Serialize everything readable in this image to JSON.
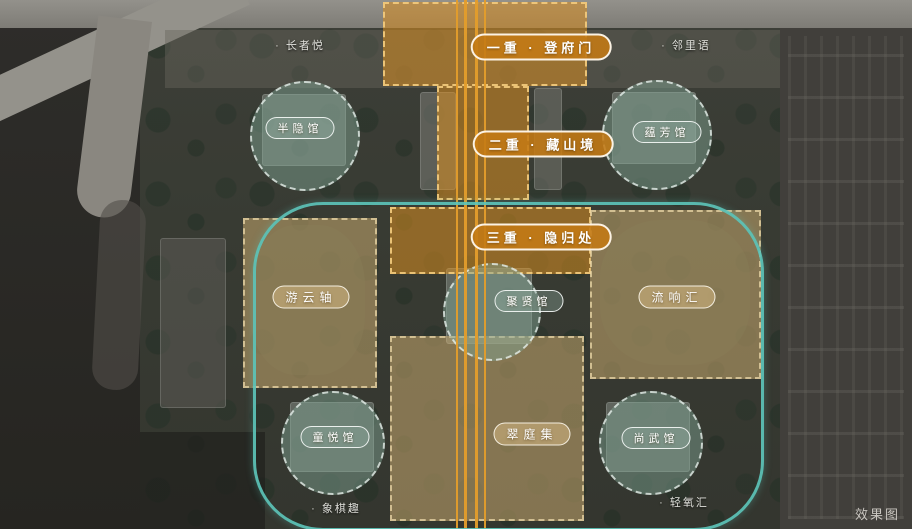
{
  "title": "小区景观规划效果图",
  "watermark": "效果图",
  "colors": {
    "axis_orange": "#e39d2b",
    "zone_orange_fill": "#d88e20",
    "zone_tan_fill": "#cfae72",
    "teal_loop": "#5cc3b8",
    "pavilion_circle_fill": "#80a293"
  },
  "axis_labels": [
    {
      "text": "一重 · 登府门"
    },
    {
      "text": "二重 · 藏山境"
    },
    {
      "text": "三重 · 隐归处"
    }
  ],
  "pavilion_labels": [
    {
      "text": "半隐馆"
    },
    {
      "text": "蕴芳馆"
    },
    {
      "text": "游云轴"
    },
    {
      "text": "聚贤馆"
    },
    {
      "text": "流响汇"
    },
    {
      "text": "童悦馆"
    },
    {
      "text": "翠庭集"
    },
    {
      "text": "尚武馆"
    }
  ],
  "poi_labels": [
    {
      "text": "· 长者悦"
    },
    {
      "text": "· 邻里语"
    },
    {
      "text": "· 象棋趣"
    },
    {
      "text": "· 轻氧汇"
    }
  ]
}
